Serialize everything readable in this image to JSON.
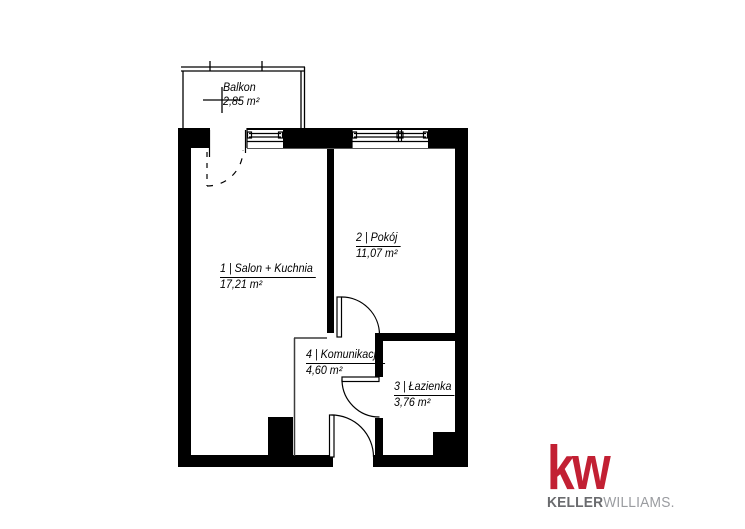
{
  "floor_plan": {
    "balcony": {
      "label": "Balkon",
      "area": "2,85 m²"
    },
    "rooms": [
      {
        "label": "1 | Salon + Kuchnia",
        "area": "17,21 m²"
      },
      {
        "label": "2 | Pokój",
        "area": "11,07 m²"
      },
      {
        "label": "3 | Łazienka",
        "area": "3,76 m²"
      },
      {
        "label": "4 | Komunikacja",
        "area": "4,60 m²"
      }
    ]
  },
  "logo": {
    "mark": "kw",
    "brand_bold": "KELLER",
    "brand_light": "WILLIAMS.",
    "red": "#c22033",
    "gray_dark": "#6a6b6e",
    "gray_light": "#9a9ca0"
  },
  "colors": {
    "wall": "#000000",
    "line": "#000000",
    "thin_line": "#3c3c3c",
    "background": "#ffffff"
  }
}
